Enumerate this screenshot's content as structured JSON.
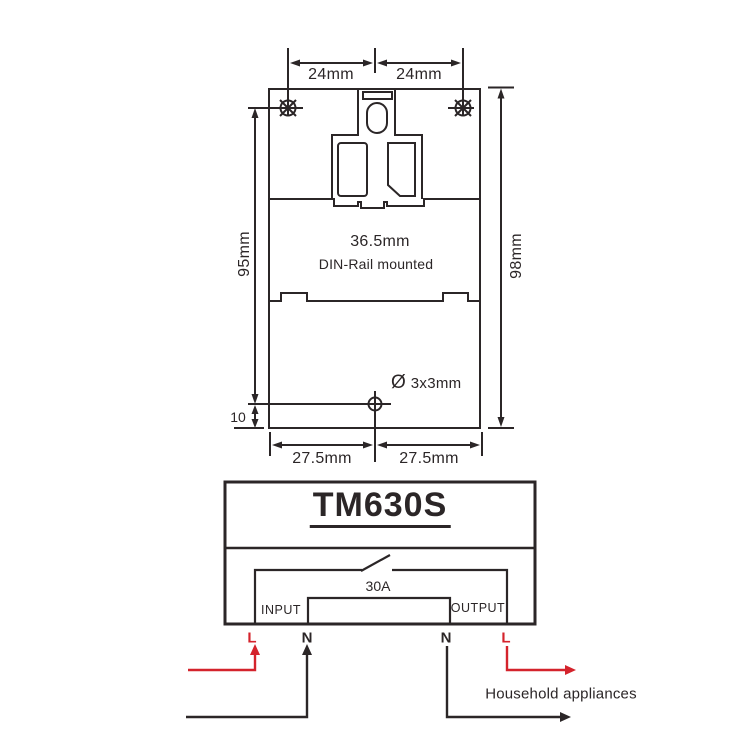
{
  "colors": {
    "line": "#2b2627",
    "accent_red": "#d4232c",
    "background": "#ffffff"
  },
  "mounting_diagram": {
    "hole_spacing_left": "24mm",
    "hole_spacing_right": "24mm",
    "hole_height": "95mm",
    "body_height": "98mm",
    "body_width": "36.5mm",
    "mount_type": "DIN-Rail mounted",
    "bottom_hole_offset": "10",
    "hole_diameter_symbol": "Ø",
    "hole_diameter": "3x3mm",
    "bottom_spacing_left": "27.5mm",
    "bottom_spacing_right": "27.5mm"
  },
  "device": {
    "model": "TM630S",
    "contact_rating": "30A",
    "input_label": "INPUT",
    "output_label": "OUTPUT"
  },
  "wiring": {
    "input_live": "L",
    "input_neutral": "N",
    "output_neutral": "N",
    "output_live": "L",
    "load_label": "Household appliances"
  }
}
